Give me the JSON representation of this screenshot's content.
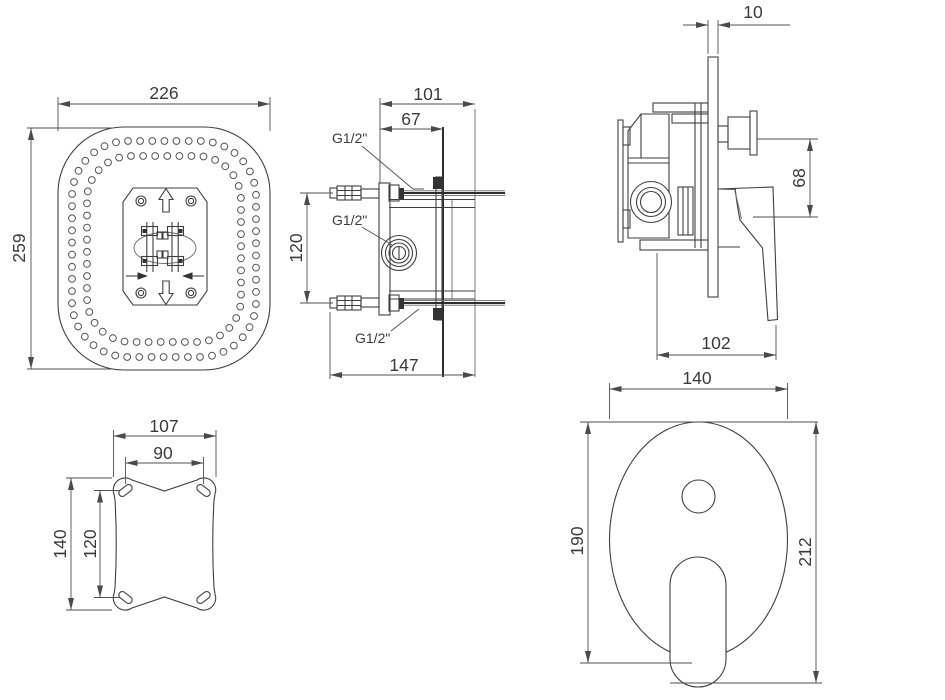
{
  "title": "concealed-shower-mixer-installation-drawing",
  "colors": {
    "background": "#ffffff",
    "line": "#3f3f3f",
    "dim_line": "#4f4f4f",
    "text": "#3a3a3a"
  },
  "views": {
    "shower_head_top": {
      "dim_width": "226",
      "dim_height": "259",
      "hole_rings": {
        "outer_count": 58,
        "inner_count": 50,
        "hole_radius": 3.4
      }
    },
    "shower_head_side": {
      "dim_depth": "101",
      "dim_projection": "67",
      "dim_port_spacing": "120",
      "dim_total_depth": "147",
      "thread_top": "G1/2\"",
      "thread_middle": "G1/2\"",
      "thread_bottom": "G1/2\""
    },
    "mixer_valve_side": {
      "dim_plate_thickness": "10",
      "dim_handle_offset": "68",
      "dim_handle_depth": "102"
    },
    "mounting_plate": {
      "dim_outer_width": "107",
      "dim_slot_span_width": "90",
      "dim_outer_height": "140",
      "dim_slot_span_height": "120"
    },
    "mixer_trim_front": {
      "dim_plate_width": "140",
      "dim_plate_height": "190",
      "dim_total_height": "212"
    }
  }
}
